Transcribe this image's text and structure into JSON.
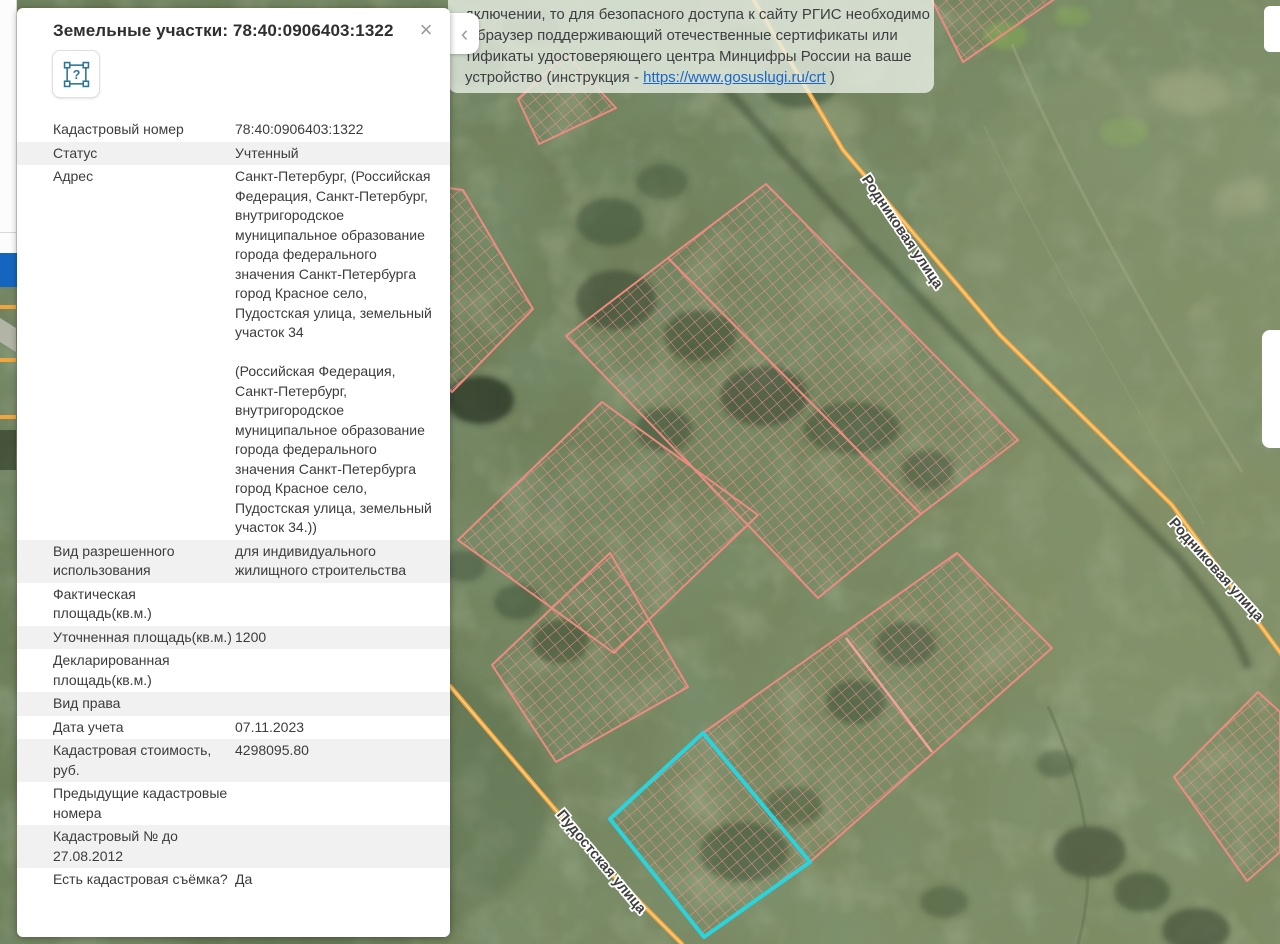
{
  "panel": {
    "title": "Земельные участки: 78:40:0906403:1322",
    "close_glyph": "×",
    "help_glyph": "?",
    "rows": [
      {
        "label": "Кадастровый номер",
        "value": "78:40:0906403:1322"
      },
      {
        "label": "Статус",
        "value": "Учтенный"
      },
      {
        "label": "Адрес",
        "value": "Санкт-Петербург, (Российская Федерация, Санкт-Петербург, внутригородское муниципальное образование города федерального значения Санкт-Петербурга город Красное село, Пудостская улица, земельный участок 34\n\n(Российская Федерация, Санкт-Петербург, внутригородское муниципальное образование города федерального значения Санкт-Петербурга город Красное село, Пудостская улица, земельный участок 34.))"
      },
      {
        "label": "Вид разрешенного использования",
        "value": "для индивидуального жилищного строительства"
      },
      {
        "label": "Фактическая площадь(кв.м.)",
        "value": ""
      },
      {
        "label": "Уточненная площадь(кв.м.)",
        "value": "1200"
      },
      {
        "label": "Декларированная площадь(кв.м.)",
        "value": ""
      },
      {
        "label": "Вид права",
        "value": ""
      },
      {
        "label": "Дата учета",
        "value": "07.11.2023"
      },
      {
        "label": "Кадастровая стоимость, руб.",
        "value": "4298095.80"
      },
      {
        "label": "Предыдущие кадастровые номера",
        "value": ""
      },
      {
        "label": "Кадастровый № до 27.08.2012",
        "value": ""
      },
      {
        "label": "Есть кадастровая съёмка?",
        "value": "Да"
      }
    ]
  },
  "collapse_glyph": "‹",
  "notification": {
    "line1": "дключении, то для безопасного доступа к сайту РГИС необходимо",
    "line2": "ь браузер поддерживающий отечественные сертификаты или",
    "line3": "тификаты удостоверяющего центра Минцифры России на ваше",
    "line4_prefix": "устройство (инструкция - ",
    "link_text": "https://www.gosuslugi.ru/crt",
    "line4_suffix": " )"
  },
  "map": {
    "road1_label": "Родниковая улица",
    "road2_label": "Пудостская улица",
    "colors": {
      "parcel_stroke": "#ee8b81",
      "hatch": "#f0948c",
      "selected_stroke": "#2bd3dc",
      "road_core": "#f2a53e",
      "road_glow": "#ffd084"
    }
  }
}
